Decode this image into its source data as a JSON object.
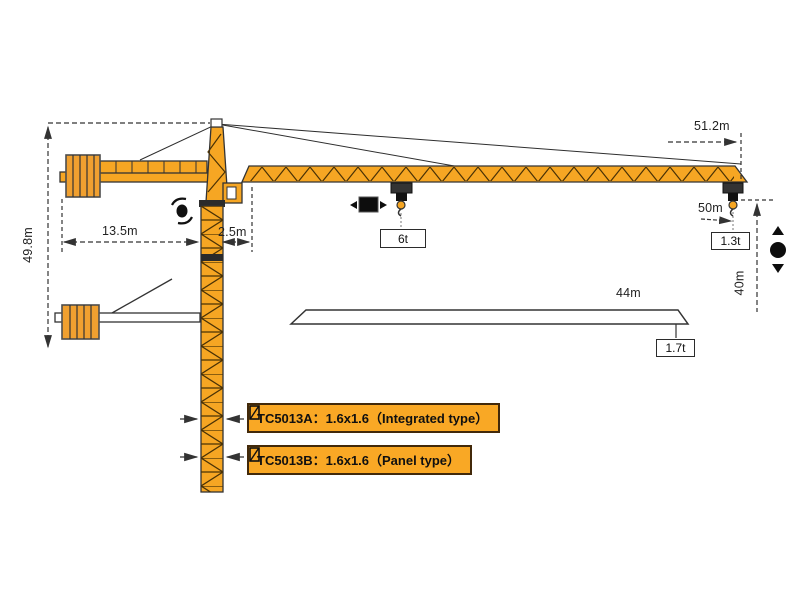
{
  "dims": {
    "height": "49.8m",
    "counter_radius": "13.5m",
    "mast_offset": "2.5m",
    "tip_radius": "51.2m",
    "load_radius": "50m",
    "hook_height": "40m",
    "mid_radius": "44m"
  },
  "loads": {
    "max_load": "6t",
    "tip_load": "1.3t",
    "mid_load": "1.7t"
  },
  "variants": [
    {
      "label": "TC5013A：1.6x1.6（Integrated type）"
    },
    {
      "label": "TC5013B：1.6x1.6（Panel type）"
    }
  ],
  "icons": {
    "slewing": "slewing-rotation-icon",
    "trolley_travel": "trolley-left-right-icon",
    "hoist": "hook-up-down-icon",
    "mast_section": "mast-section-icon"
  },
  "colors": {
    "crane": "#F6A623",
    "outline": "#333333",
    "label_box_bg": "#F9A825",
    "label_box_border": "#42290A",
    "dim_text": "#222222"
  }
}
